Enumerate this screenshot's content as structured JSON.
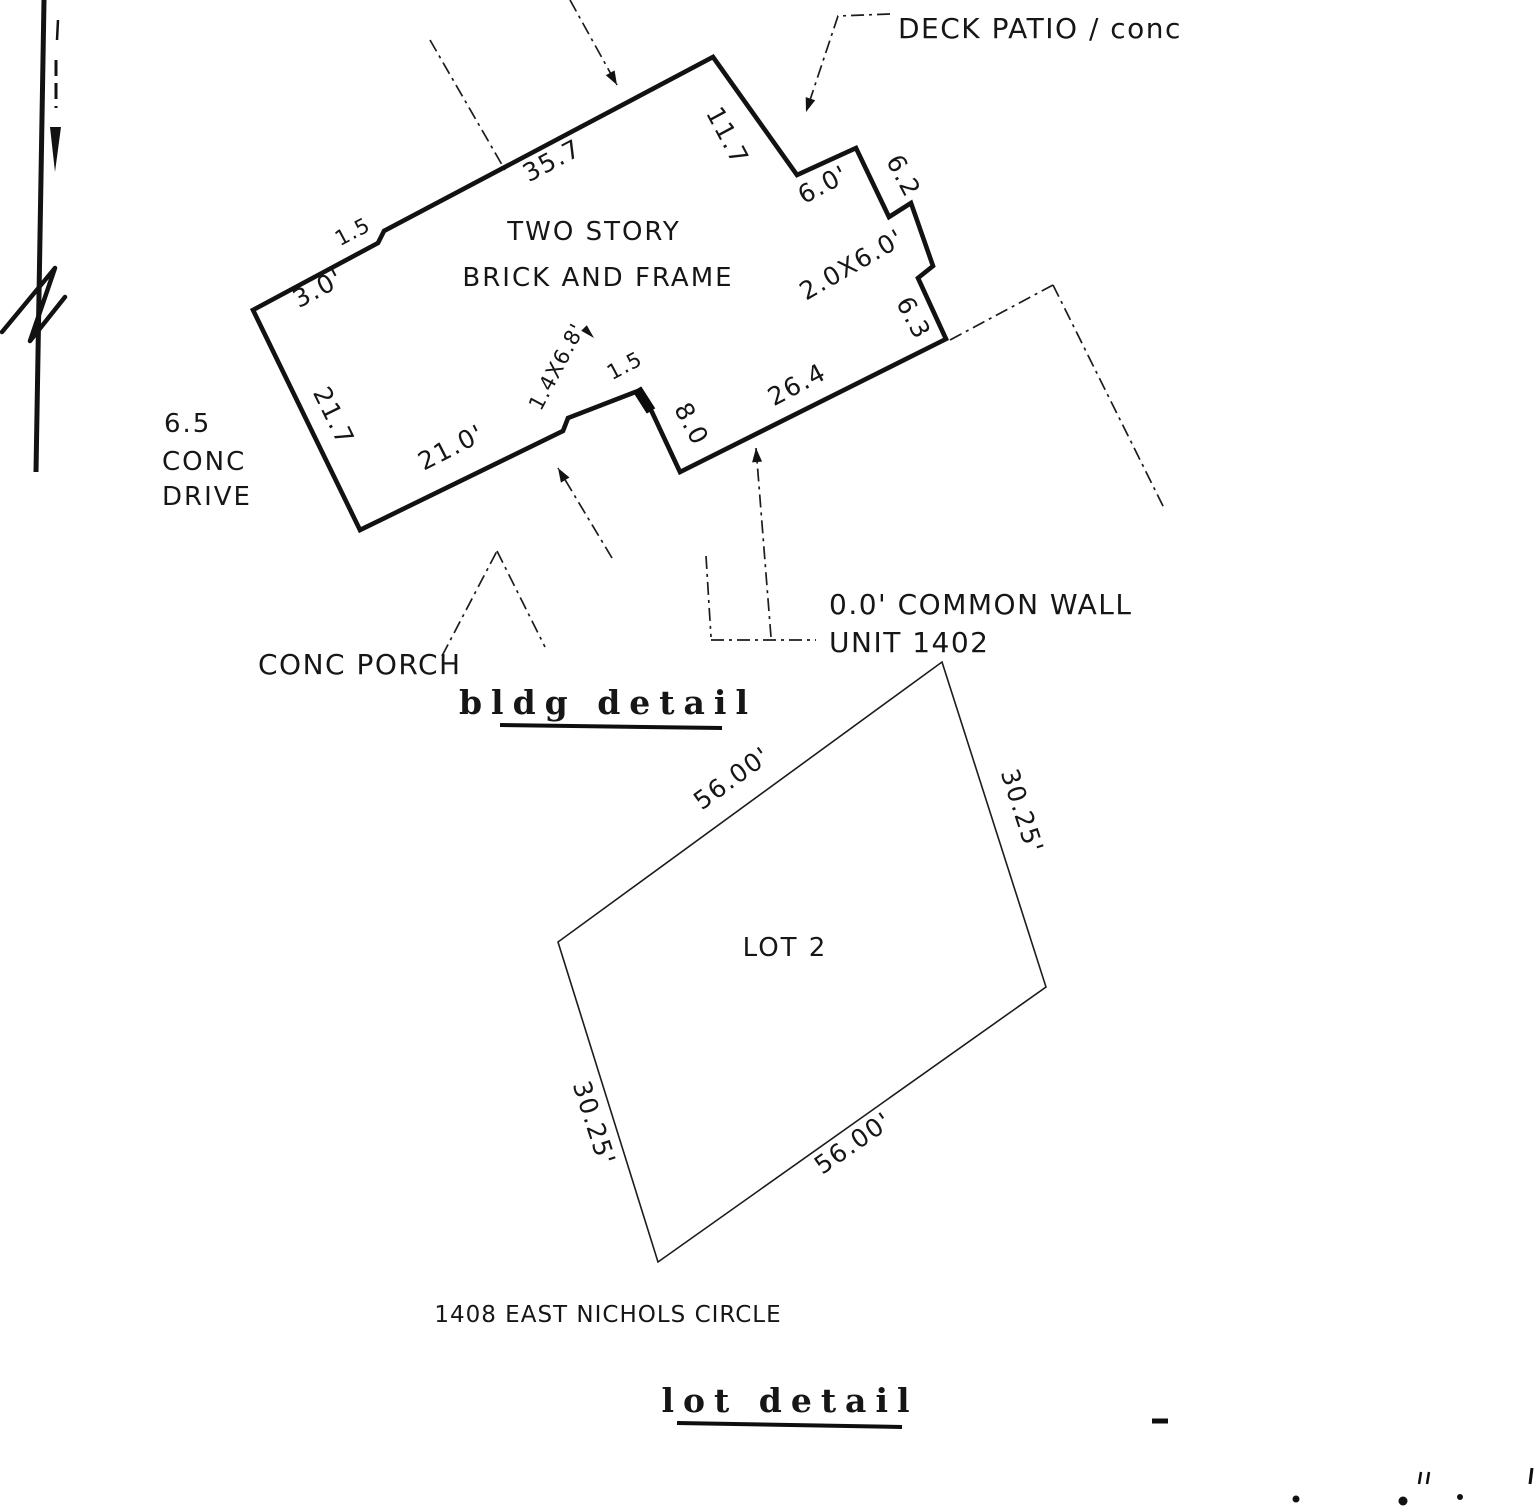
{
  "drawing": {
    "north_label": "N",
    "bldg_detail": {
      "title": "bldg detail",
      "building_line1": "TWO STORY",
      "building_line2": "BRICK AND FRAME",
      "deck_patio": "DECK PATIO / conc",
      "conc_drive_width": "6.5",
      "conc_drive_word1": "CONC",
      "conc_drive_word2": "DRIVE",
      "conc_porch": "CONC PORCH",
      "common_wall_line1": "0.0' COMMON WALL",
      "common_wall_line2": "UNIT 1402",
      "dims": {
        "front_wall": "35.7",
        "upper_right_wall": "11.7",
        "deck_step": "6.0'",
        "deck_side": "6.2",
        "bump_out": "2.0X6.0'",
        "bump_side": "6.3",
        "rear_wall": "26.4",
        "common_side": "8.0",
        "common_offset": "1.5",
        "porch_size": "1.4X6.8'",
        "bottom_wall": "21.0'",
        "left_wall": "21.7",
        "front_jog": "1.5",
        "front_corner": "3.0'"
      }
    },
    "lot_detail": {
      "title": "lot detail",
      "lot_name": "LOT 2",
      "address": "1408 EAST NICHOLS CIRCLE",
      "dims": {
        "top_edge": "56.00'",
        "bottom_edge": "56.00'",
        "left_edge": "30.25'",
        "right_edge": "30.25'"
      }
    }
  }
}
